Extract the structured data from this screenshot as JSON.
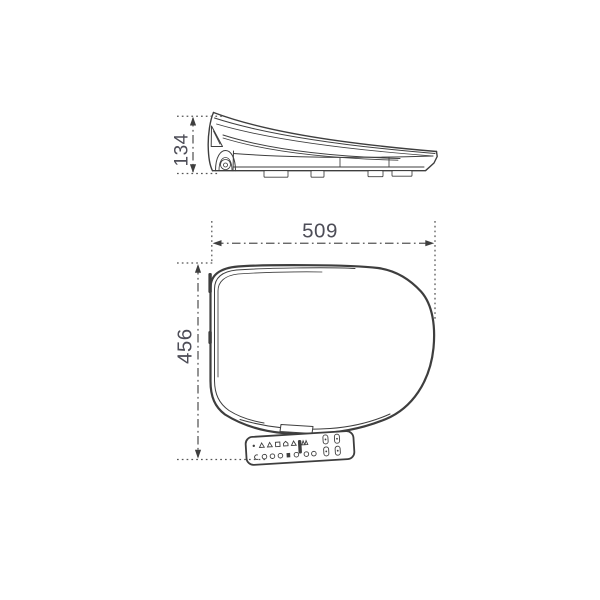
{
  "dimensions": {
    "side_height": "134",
    "top_width": "509",
    "top_depth": "456"
  },
  "colors": {
    "background": "#ffffff",
    "line": "#3e3e3e",
    "dimension_line": "#555555",
    "dimension_text": "#4d4d57"
  },
  "views": {
    "side_view": "seat side profile",
    "top_view": "seat top plan",
    "control_panel": "side control panel with buttons"
  }
}
